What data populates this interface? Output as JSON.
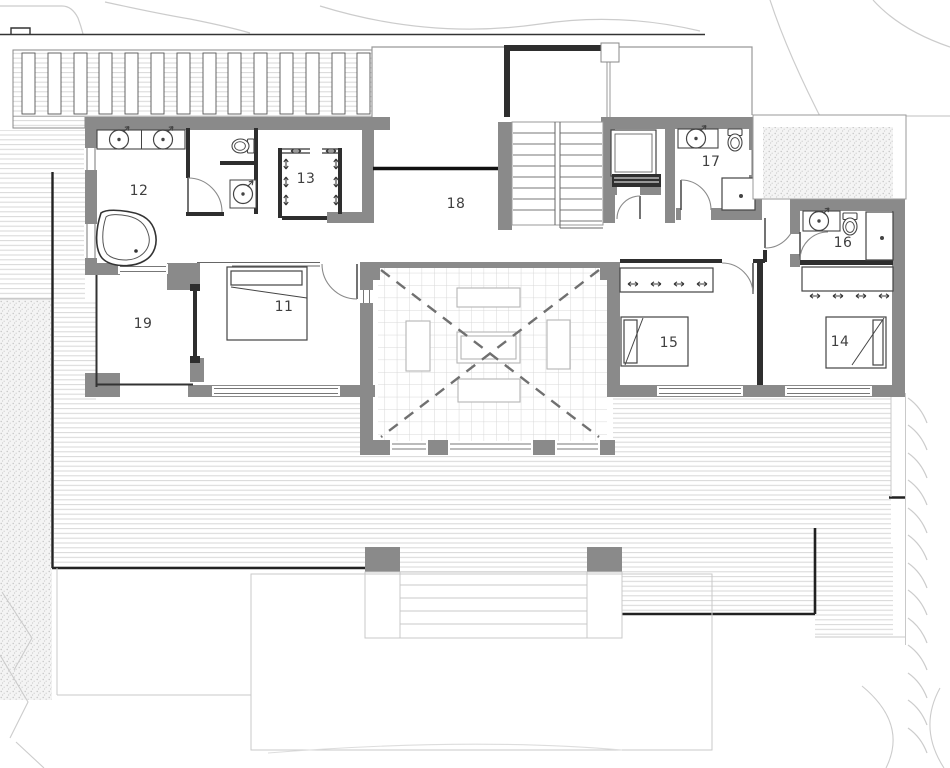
{
  "plan": {
    "kind": "architectural-floor-plan",
    "rooms_visible": 9
  },
  "rooms": [
    {
      "label": "11"
    },
    {
      "label": "12"
    },
    {
      "label": "13"
    },
    {
      "label": "14"
    },
    {
      "label": "15"
    },
    {
      "label": "16"
    },
    {
      "label": "17"
    },
    {
      "label": "18"
    },
    {
      "label": "19"
    }
  ],
  "fixtures": [
    "sink-icon",
    "toilet-icon",
    "bathtub-icon",
    "shower-icon",
    "bed-icon",
    "hanger-icon",
    "washing-machine-icon",
    "staircase-icon",
    "railing",
    "void-open-to-below"
  ],
  "colors": {
    "wall": "#8a8a8a",
    "thin_wall": "#2e2e2e",
    "deck_line": "#d7d7d7",
    "tile_line": "#d8d8d8",
    "label": "#3f3f3f",
    "contour": "#cccccc"
  }
}
